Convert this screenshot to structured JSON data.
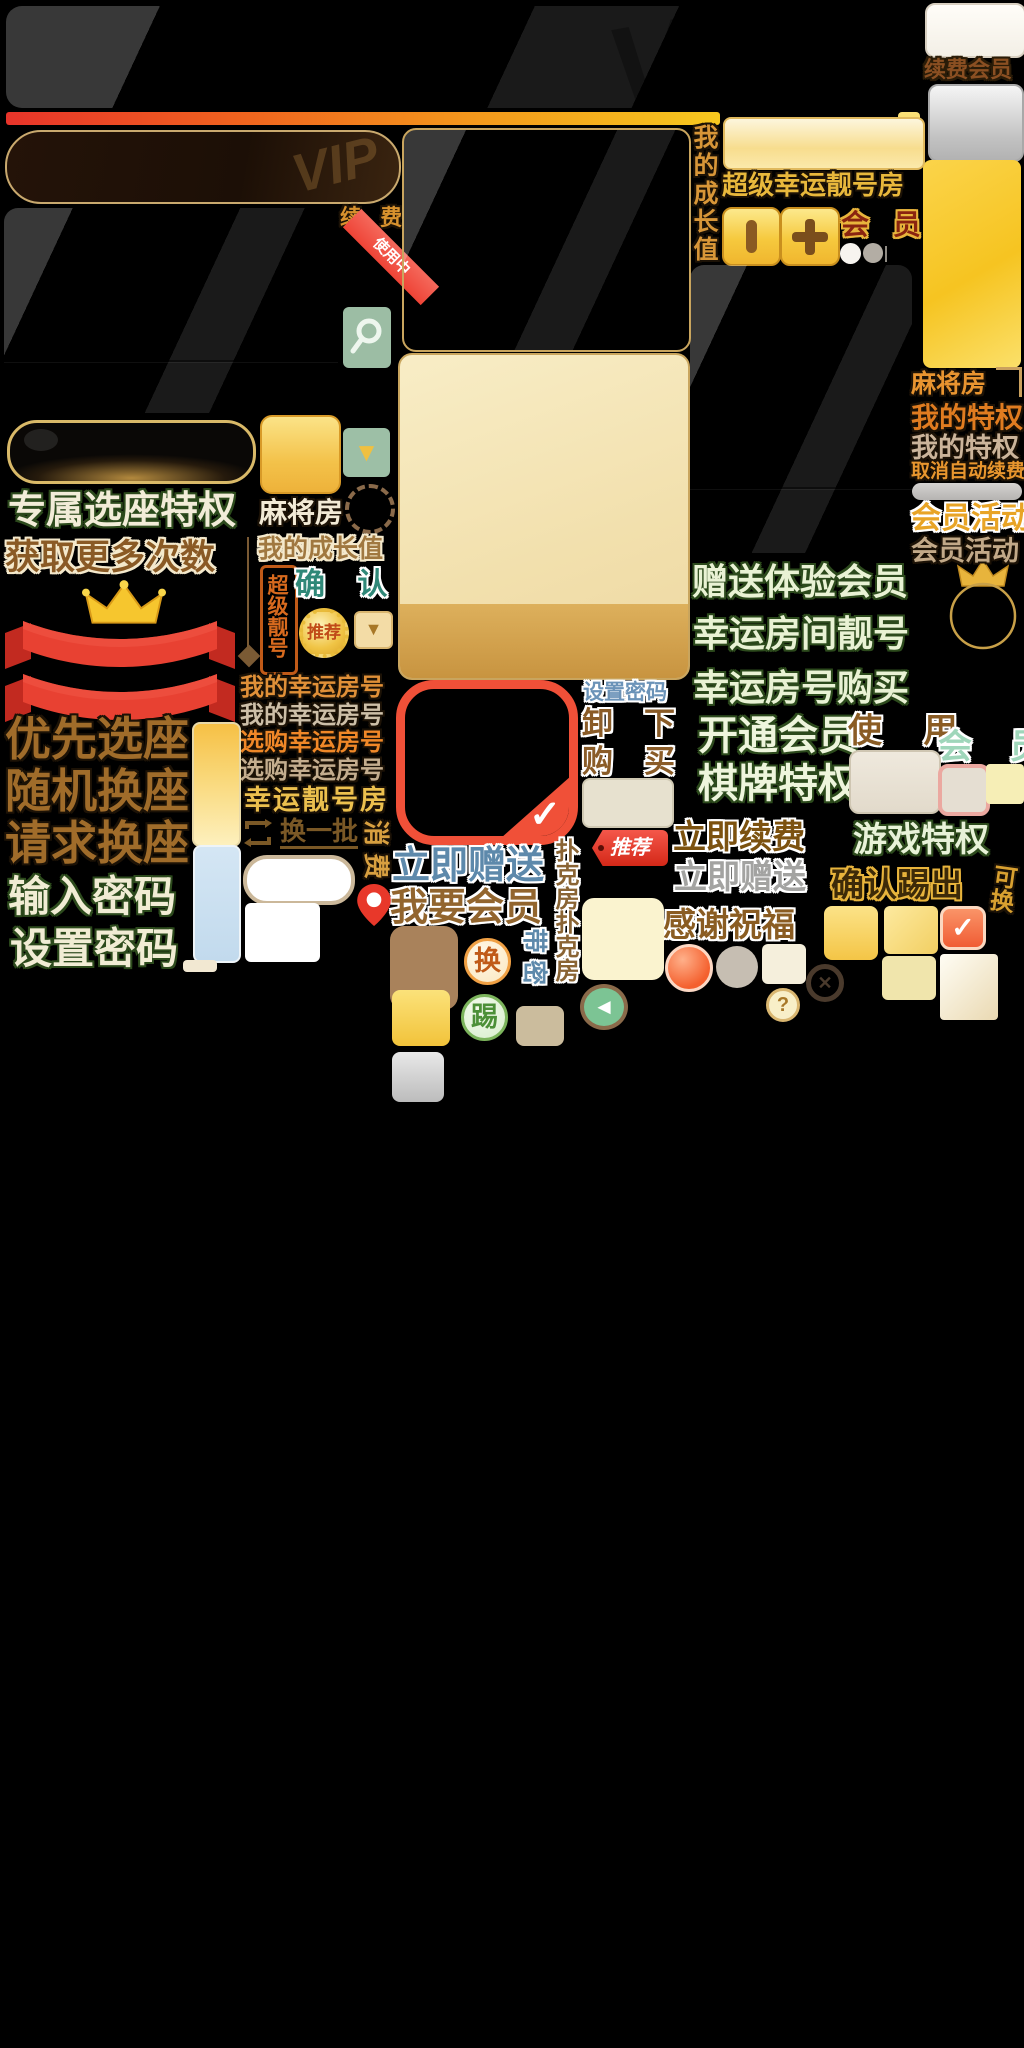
{
  "atlas_title": "VIP会员界面素材图集",
  "colors": {
    "accent_red": "#f05038",
    "accent_gold": "#f6c93e",
    "accent_green_text": "#eef3da",
    "accent_blue_text": "#5d89ab",
    "sage_button": "#9cbda4",
    "ribbon_red": "#e23b30"
  },
  "labels": {
    "vip_watermark": "VIP",
    "renew_member": "续费会员",
    "growth_value_vertical": "我的成长值",
    "super_lucky_room": "超级幸运靓号房",
    "bar_glyph": "▮",
    "plus_glyph": "+",
    "member_red": "会 员",
    "renew_spaced": "续 费",
    "in_use": "使用中",
    "exclusive_seat": "专属选座特权",
    "mahjong_room_left": "麻将房",
    "growth_value": "我的成长值",
    "get_more_times": "获取更多次数",
    "super_number_tag": "超级靓号",
    "confirm_spaced": "确 认",
    "recommend_badge": "推荐",
    "recommend_tag": "推荐",
    "my_lucky_room_1": "我的幸运房号",
    "my_lucky_room_2": "我的幸运房号",
    "buy_lucky_room_1": "选购幸运房号",
    "buy_lucky_room_2": "选购幸运房号",
    "lucky_number_room": "幸运靓号房",
    "change_batch": "换一批",
    "rotated_gold_1": "消",
    "rotated_gold_2": "费",
    "priority_seat": "优先选座",
    "random_swap_seat": "随机换座",
    "request_swap_seat": "请求换座",
    "enter_password": "输入密码",
    "set_password_green": "设置密码",
    "set_password_blue": "设置密码",
    "uninstall_a": "卸",
    "uninstall_b": "下",
    "purchase_a": "购",
    "purchase_b": "买",
    "give_now_blue": "立即赠送",
    "want_member": "我要会员",
    "poker_room_x2": "扑克房扑克房",
    "rotated_blue_1": "带",
    "rotated_blue_2": "密",
    "swap_char": "换",
    "kick_char": "踢",
    "gift_trial_member": "赠送体验会员",
    "lucky_room_number": "幸运房间靓号",
    "lucky_number_buy": "幸运房号购买",
    "open_member": "开通会员",
    "use_spaced": "使 用",
    "member_mint": "会 员",
    "chess_privilege": "棋牌特权",
    "renew_now": "立即续费",
    "game_privilege": "游戏特权",
    "give_now_silver": "立即赠送",
    "confirm_kick": "确认踢出",
    "can_swap_vertical": "可换",
    "thanks_blessing": "感谢祝福",
    "mahjong_room_gold": "麻将房",
    "my_privilege_orange": "我的特权",
    "my_privilege_beige": "我的特权",
    "cancel_auto_renew": "取消自动续费",
    "member_activity_gold": "会员活动",
    "member_activity_beige": "会员活动",
    "question_mark": "?",
    "check_mark": "✓",
    "back_arrow": "◄",
    "close_x": "✕",
    "dropdown_arrow": "▼"
  }
}
